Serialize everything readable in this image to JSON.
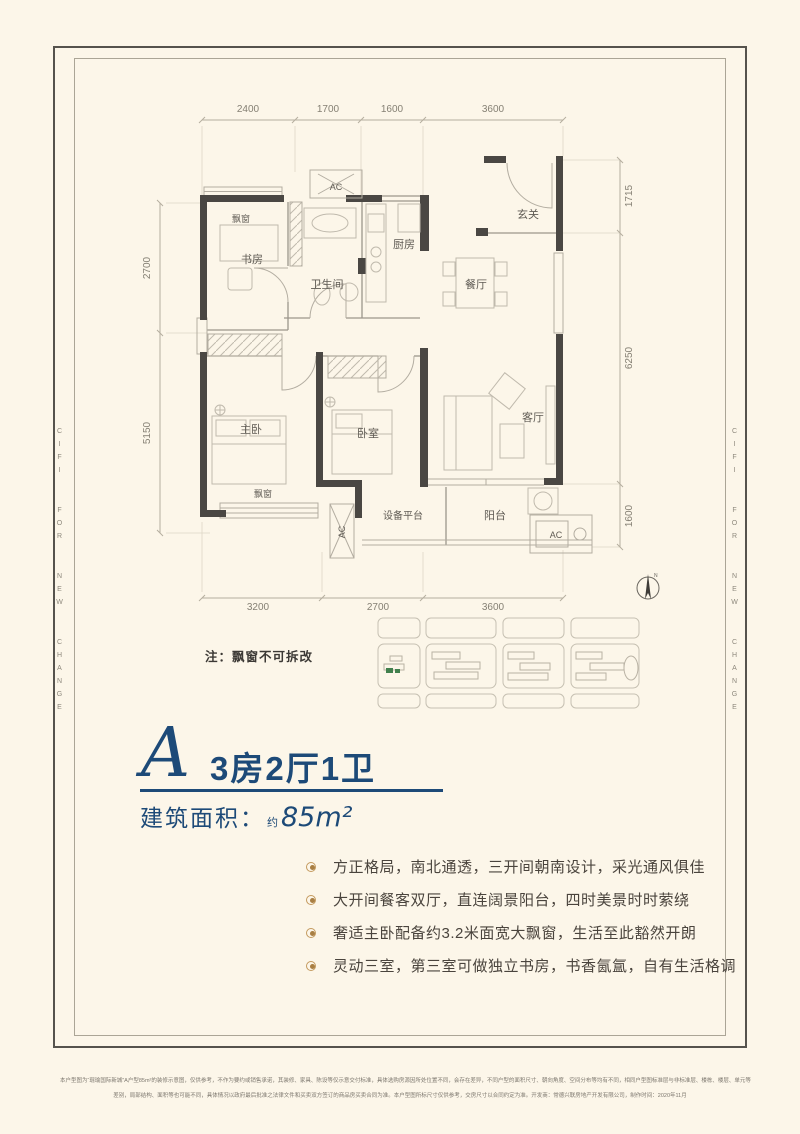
{
  "colors": {
    "background": "#fcf6e9",
    "accent_blue": "#1d4a78",
    "wall": "#4a4743",
    "bullet_gold": "#c49a5e",
    "site_green": "#41804d"
  },
  "side_text": "CIFI FOR NEW CHANGE",
  "floorplan": {
    "dims_top": [
      "2400",
      "1700",
      "1600",
      "3600"
    ],
    "dims_left": [
      "2700",
      "5150"
    ],
    "dims_right": [
      "1715",
      "6250",
      "1600"
    ],
    "dims_bottom": [
      "3200",
      "2700",
      "3600"
    ],
    "rooms": {
      "bay_top": "飘窗",
      "study": "书房",
      "ac_top": "AC",
      "bath": "卫生间",
      "kitchen": "厨房",
      "foyer": "玄关",
      "dining": "餐厅",
      "master": "主卧",
      "bedroom": "卧室",
      "living": "客厅",
      "bay_bottom": "飘窗",
      "ac_left": "AC",
      "equipment": "设备平台",
      "balcony": "阳台",
      "ac_right": "AC"
    },
    "note": "注：飘窗不可拆改"
  },
  "unit": {
    "letter": "A",
    "layout": "3房2厅1卫",
    "area_label": "建筑面积：",
    "area_prefix": "约",
    "area_value": "85m²"
  },
  "features": [
    "方正格局，南北通透，三开间朝南设计，采光通风俱佳",
    "大开间餐客双厅，直连阔景阳台，四时美景时时萦绕",
    "奢适主卧配备约3.2米面宽大飘窗，生活至此豁然开朗",
    "灵动三室，第三室可做独立书房，书香氤氲，自有生活格调"
  ],
  "disclaimer": {
    "line1": "本户型图为“琨瑜国际新城”A户型85m²的装修示意图，仅供参考，不作为要约或销售承诺，其装修、家具、陈设等仅示意交付标准，具体选购房源因所处位置不同，会存在差异，不同户型的面积尺寸、朝向角度、空间分布等均有不同，相同户型图标准层与非标准层、楼栋、楼层、单元等",
    "line2": "差别，局部结构、面积等也可能不同，具体情况以政府最后批准之法律文件和买卖双方签订的商品房买卖合同为准。本户型图所标尺寸仅供参考，交房尺寸以合同约定为准。开发商：常德兴联房地产开发有限公司，制作时间：2020年11月"
  }
}
